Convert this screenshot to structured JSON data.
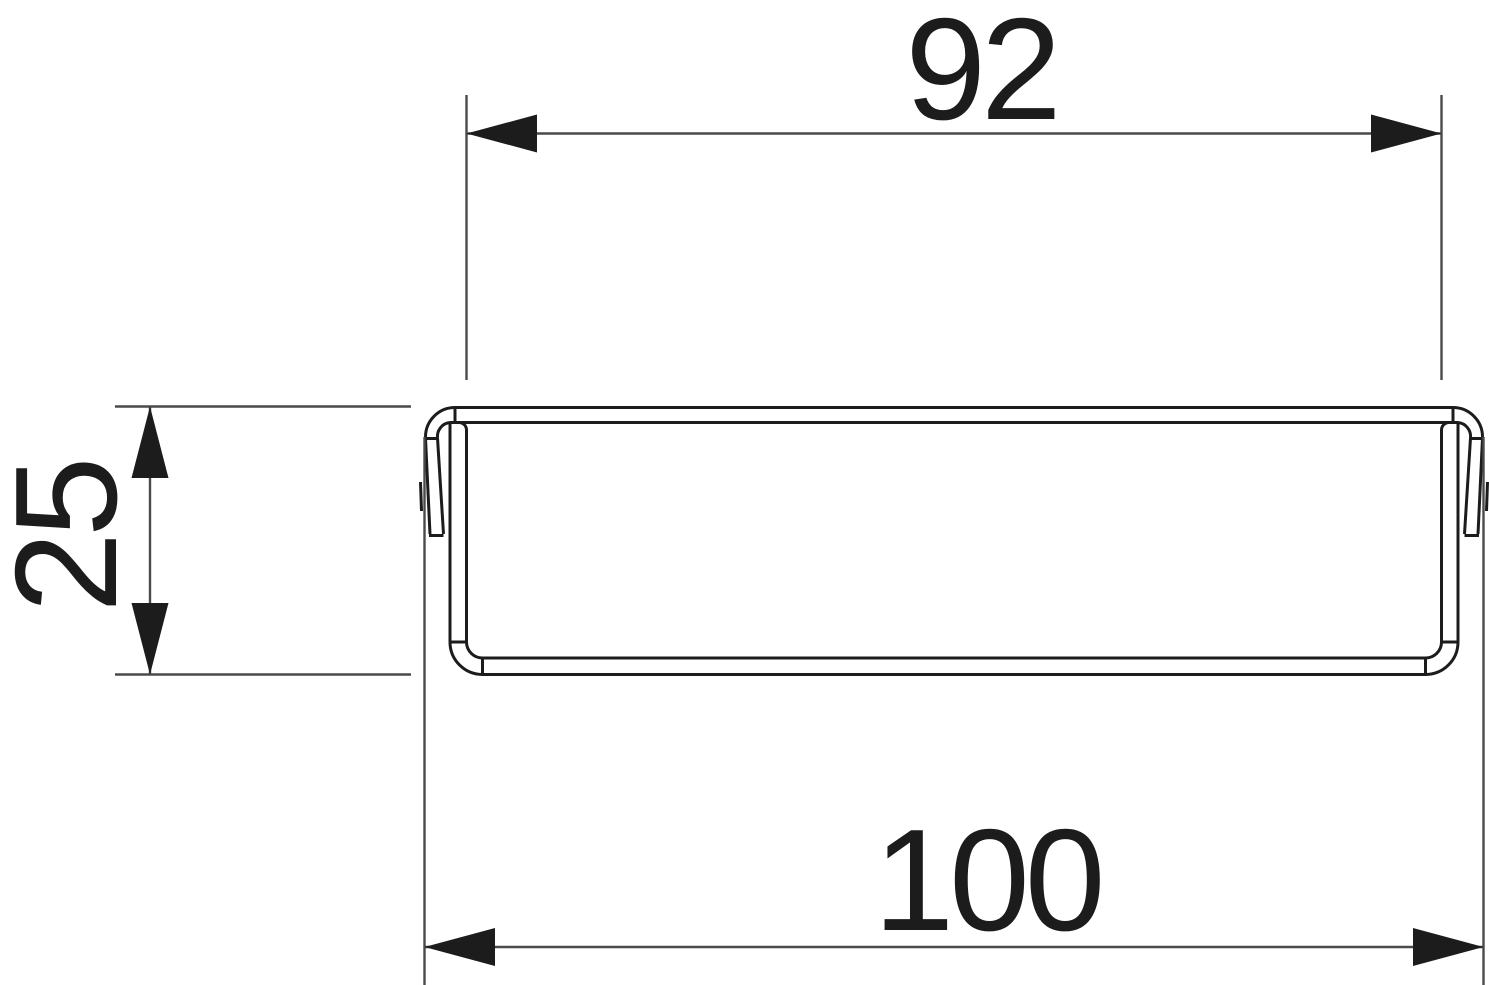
{
  "drawing": {
    "dimensions": {
      "top": {
        "label": "92",
        "value": 92,
        "orientation": "horizontal"
      },
      "left": {
        "label": "25",
        "value": 25,
        "orientation": "vertical"
      },
      "bottom": {
        "label": "100",
        "value": 100,
        "orientation": "horizontal"
      }
    },
    "colors": {
      "background": "#ffffff",
      "object_line": "#1c1c1c",
      "dimension_line": "#4a4a4a",
      "text": "#1c1c1c"
    }
  }
}
